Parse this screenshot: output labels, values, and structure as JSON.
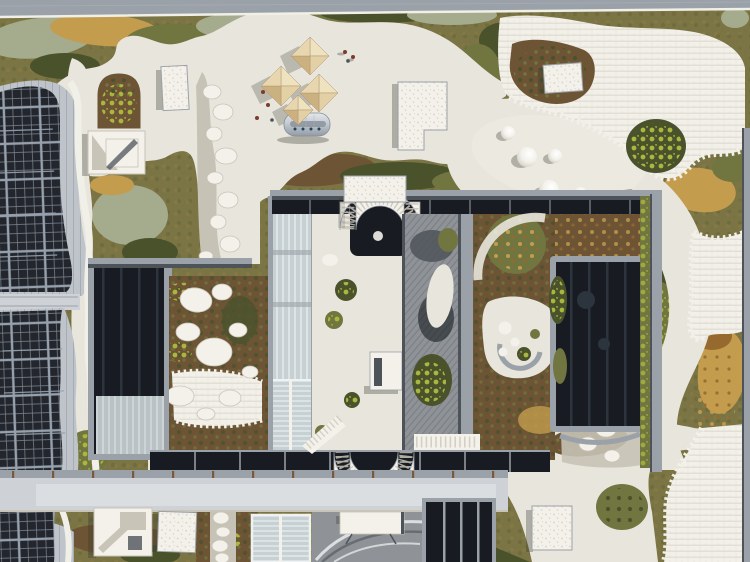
{
  "scene": {
    "description": "Aerial drone view of a large building rooftop garden: winding white concrete paths through olive, brown and lime green-roof planting, a rooftop solar array on the left, a parasol terrace with a silver food trailer and visitors, white gravel skylight boxes, domed skylights on a concrete plaza, a central sunken courtyard framed by dark glazed voids with two white ribbed spiral ramps, a louvered roof section, and a long footbridge crossing the lower rooftop",
    "objects": [
      {
        "name": "solar-array",
        "count": 3
      },
      {
        "name": "parasol",
        "count": 4
      },
      {
        "name": "food-trailer",
        "count": 1
      },
      {
        "name": "person",
        "count": 3
      },
      {
        "name": "skylight-dome",
        "count": 5
      },
      {
        "name": "gravel-skylight-box",
        "count": 4
      },
      {
        "name": "stair-bulkhead",
        "count": 2
      },
      {
        "name": "ribbed-spiral-ramp",
        "count": 2
      },
      {
        "name": "glazed-courtyard-void",
        "count": 3
      },
      {
        "name": "footbridge",
        "count": 1
      },
      {
        "name": "stepping-stone-path",
        "count": 4
      },
      {
        "name": "paver-field",
        "count": 3
      }
    ]
  },
  "colors": {
    "veg_base": "#7b7444",
    "veg_sage": "#a5ab8d",
    "veg_olive": "#717540",
    "veg_brown": "#6c5434",
    "veg_dark": "#4a522c",
    "veg_lime": "#aab73e",
    "veg_gold": "#c39c4e",
    "veg_rust": "#96692f",
    "concrete": "#e8e5dc",
    "concrete_shadow": "#c8c4b8",
    "paver": "#f2f0e9",
    "paver_line": "#dcd8cc",
    "white_box": "#f3f1ea",
    "gravel_dot": "#d5d1c6",
    "gravel_band": "#c6c2b5",
    "panel": "#23272d",
    "panel_line": "#7d8792",
    "panel_block": "#97a1ad",
    "roof_seam": "#bfc4ca",
    "roof_seam_line": "#a6acb3",
    "metal_frame": "#9ba1a8",
    "metal_dark": "#4e5359",
    "glass_dark": "#181c22",
    "glass_streak": "#2c353e",
    "glass_sky": "#c7d1d3",
    "mullion": "#eef2f2",
    "louver": "#8f9398",
    "louver_line": "#7a7f85",
    "bridge": "#ced2d6",
    "bridge_panel": "#dbdee1",
    "tick_brown": "#7b5836",
    "umbrella_n": "#efe2bf",
    "umbrella_e": "#e3d0a5",
    "umbrella_s": "#cbb080",
    "umbrella_w": "#e8d7ae",
    "trailer_dark": "#8e969f",
    "person": "#7c3c2b",
    "white_edge": "#f0efe8"
  }
}
